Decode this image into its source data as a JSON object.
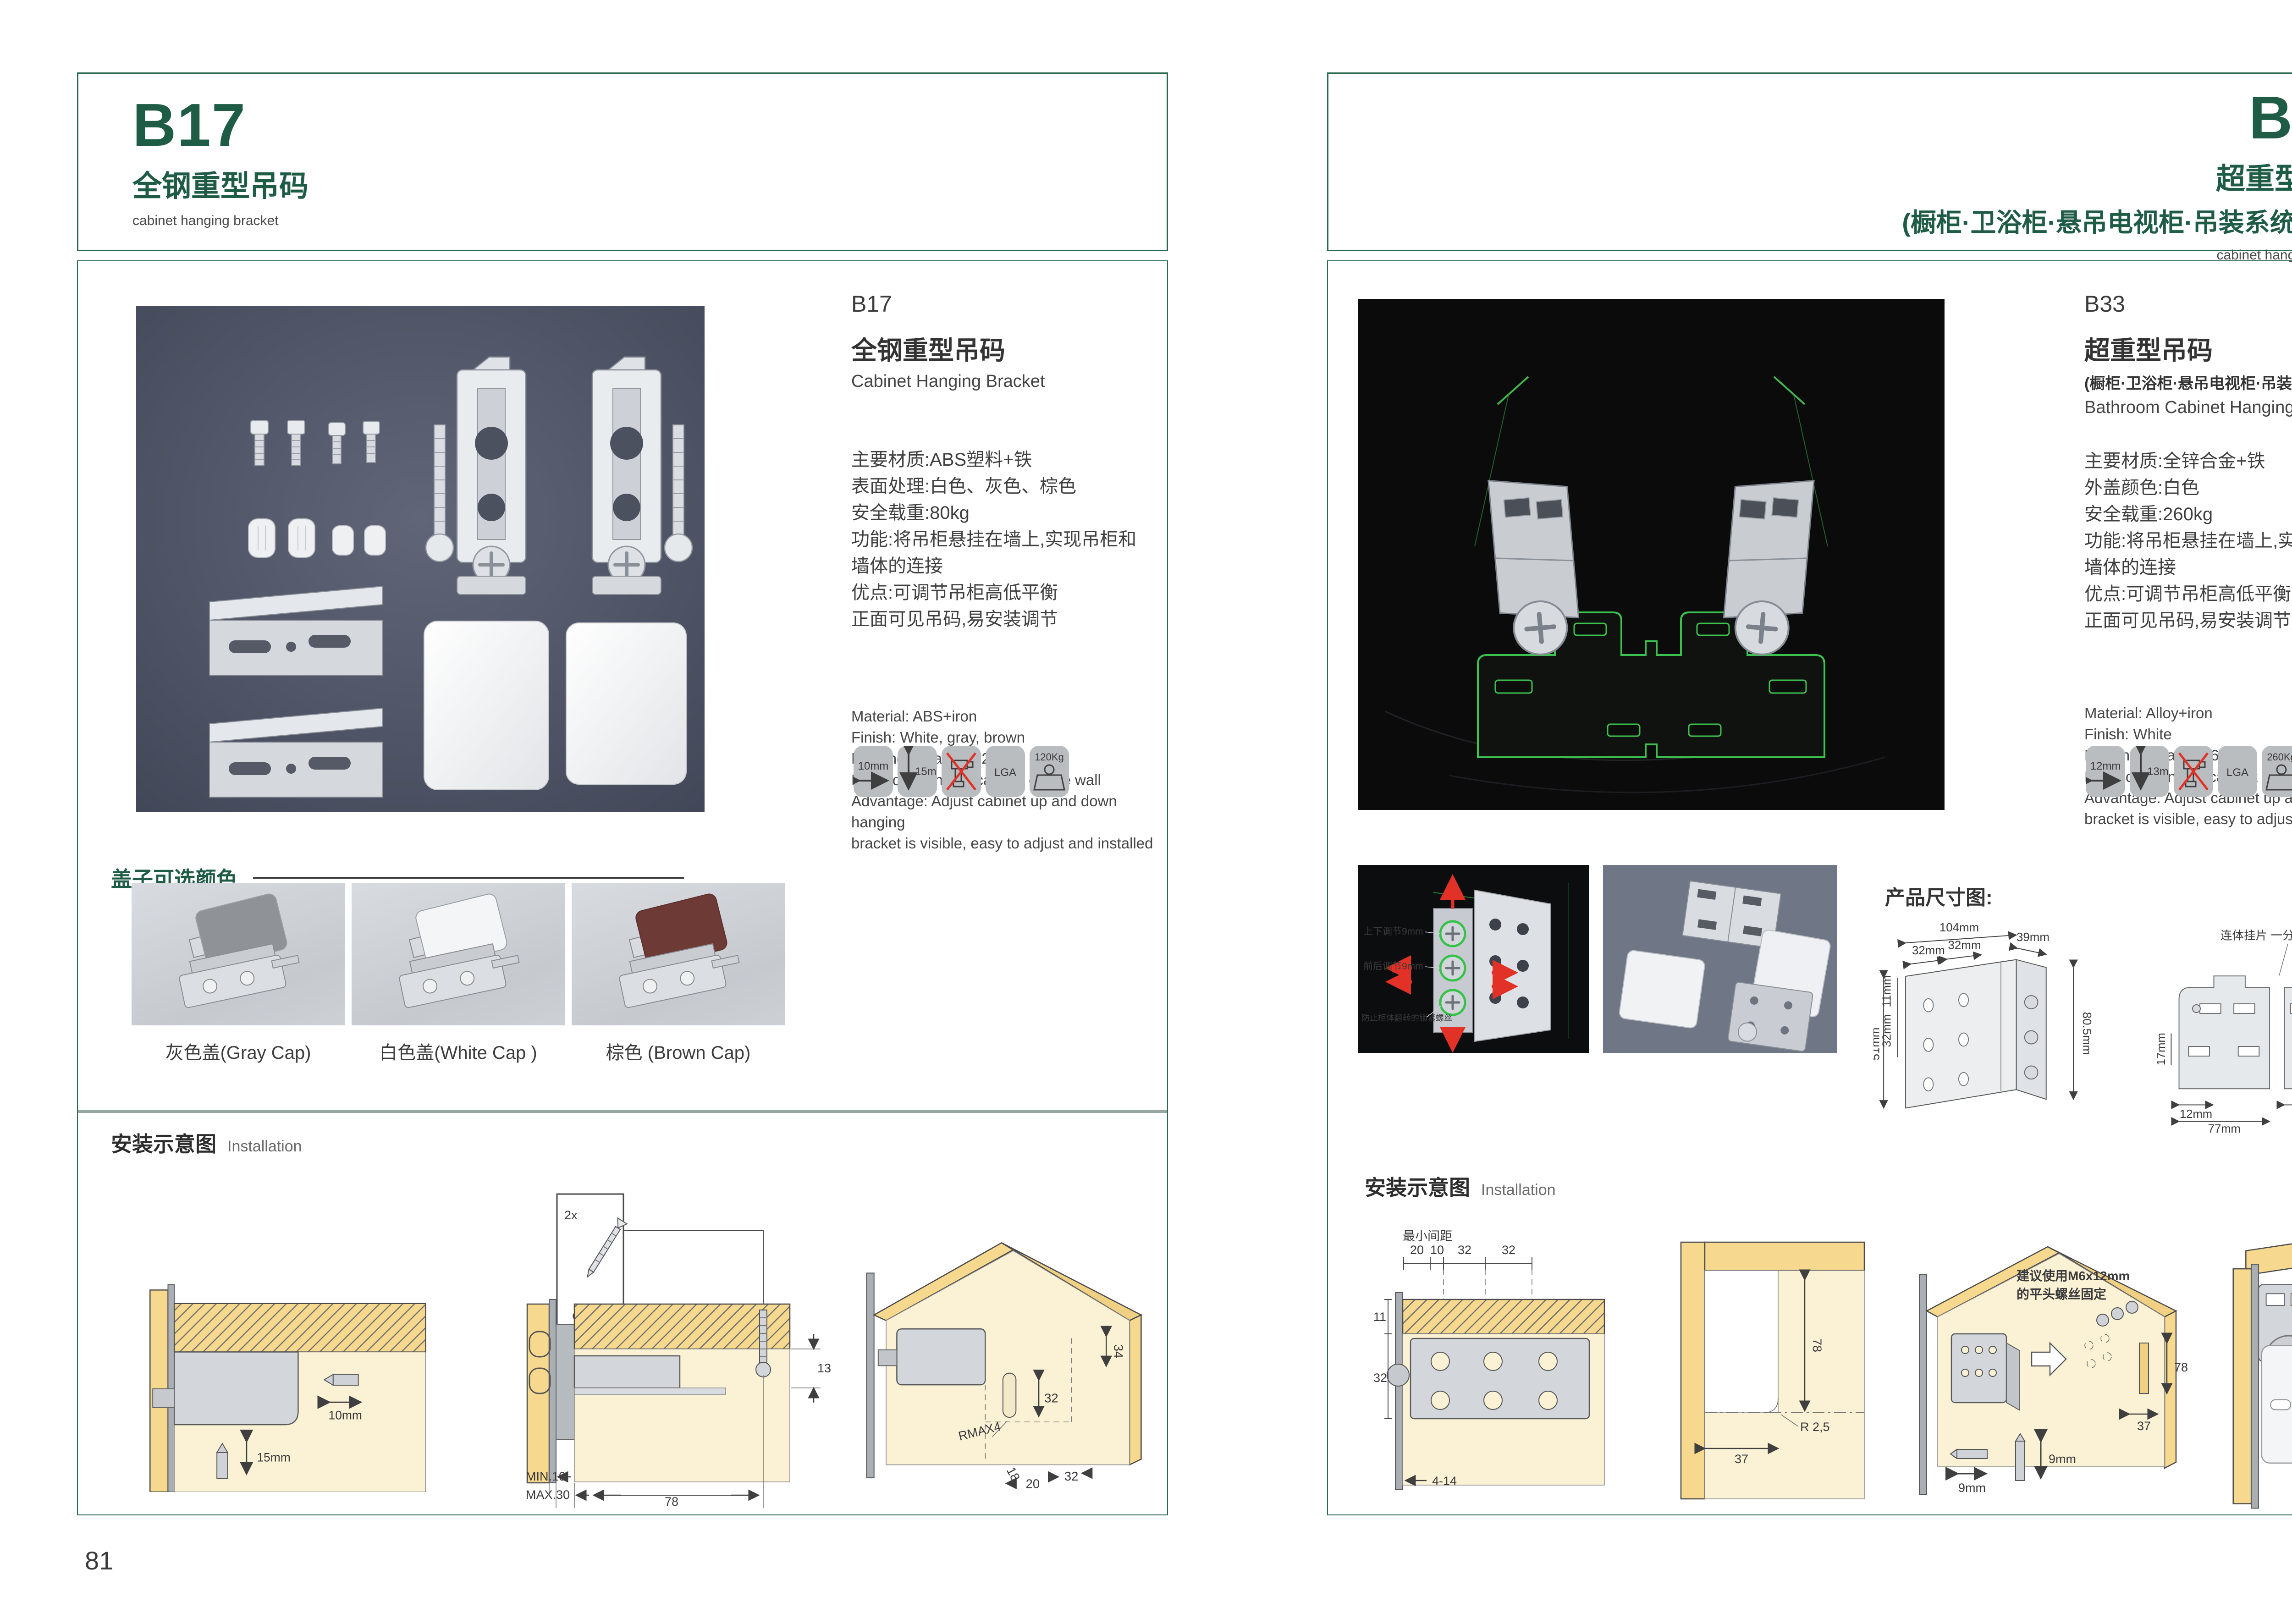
{
  "colors": {
    "brand_green": "#1f5c46",
    "laser_green": "#3cc24e",
    "warn_red": "#e23127",
    "tile_gray": "#b9bdc0"
  },
  "left": {
    "header": {
      "code": "B17",
      "title": "全钢重型吊码",
      "subtitle": "cabinet hanging bracket"
    },
    "info": {
      "code": "B17",
      "title": "全钢重型吊码",
      "title_en": "Cabinet Hanging Bracket",
      "cn": [
        "主要材质:ABS塑料+铁",
        "表面处理:白色、灰色、棕色",
        "安全载重:80kg",
        "功能:将吊柜悬挂在墙上,实现吊柜和",
        "墙体的连接",
        "优点:可调节吊柜高低平衡",
        "正面可见吊码,易安装调节"
      ],
      "en": [
        "Material: ABS+iron",
        "Finish: White, gray, brown",
        "Loading capacity: 120kg",
        "Function: hanging cabinet on the wall",
        "Advantage: Adjust cabinet up and down hanging",
        "bracket is visible, easy to adjust and installed"
      ]
    },
    "icons": {
      "w": "10mm",
      "h": "15mm",
      "lga": "LGA",
      "load": "120Kg"
    },
    "colors_section": {
      "title": "盖子可选颜色",
      "captions": [
        "灰色盖(Gray Cap)",
        "白色盖(White Cap )",
        "棕色 (Brown Cap)"
      ],
      "hex": [
        "#8f9296",
        "#f4f5f6",
        "#6e3a36"
      ]
    },
    "install": {
      "title": "安装示意图",
      "subtitle": "Installation",
      "screw_count": "2x",
      "screw_dia": "φ4mm",
      "d1_w": "10mm",
      "d1_h": "15mm",
      "d2_13": "13",
      "d2_min": "MIN.10",
      "d2_max": "MAX.30",
      "d2_78": "78",
      "d3_34": "34",
      "d3_32a": "32",
      "d3_rmax": "RMAX4",
      "d3_18": "18",
      "d3_20": "20",
      "d3_32b": "32"
    },
    "page_no": "81"
  },
  "right": {
    "header": {
      "code": "B33",
      "title": "超重型吊码",
      "paren": "(橱柜·卫浴柜·悬吊电视柜·吊装系统 专用)",
      "subtitle": "cabinet hanging bracket"
    },
    "info": {
      "code": "B33",
      "title": "超重型吊码",
      "paren": "(橱柜·卫浴柜·悬吊电视柜·吊装系统 专用)",
      "title_en": "Bathroom Cabinet Hanging Bracket",
      "cn": [
        "主要材质:全锌合金+铁",
        "外盖颜色:白色",
        "安全载重:260kg",
        "功能:将吊柜悬挂在墙上,实现吊柜和",
        "墙体的连接",
        "优点:可调节吊柜高低平衡",
        "正面可见吊码,易安装调节"
      ],
      "en": [
        "Material: Alloy+iron",
        "Finish: White",
        "Loading capacity:260kg",
        "Function: hanging cabinet on the wall",
        "Advantage: Adjust cabinet up and down hanging",
        "bracket is visible, easy to adjust and installed"
      ]
    },
    "icons": {
      "w": "12mm",
      "h": "13mm",
      "lga": "LGA",
      "load": "260Kg"
    },
    "photo1": {
      "l1": "上下调节9mm",
      "l2": "前后调节9mm",
      "l3": "防止柜体翻转的锁紧螺丝"
    },
    "dims": {
      "title": "产品尺寸图:",
      "a": {
        "d104": "104mm",
        "d32a": "32mm",
        "d32b": "32mm",
        "d39": "39mm",
        "d11": "11mm",
        "d32c": "32mm",
        "d51": "51mm",
        "d805": "80.5mm"
      },
      "b": {
        "label": "连体挂片 一分为二",
        "d55t": "55mm",
        "d39": "39mm",
        "d55r": "55mm",
        "d8": "8mm",
        "d17": "17mm",
        "d12": "12mm",
        "d63": "63mm",
        "d77": "77mm"
      }
    },
    "install": {
      "title": "安装示意图",
      "subtitle": "Installation",
      "r1_min": "最小间距",
      "r1_20": "20",
      "r1_10": "10",
      "r1_32a": "32",
      "r1_32b": "32",
      "r1_11": "11",
      "r1_32c": "32",
      "r1_414": "4-14",
      "r2_78": "78",
      "r2_r": "R 2,5",
      "r2_37": "37",
      "r3_t1": "建议使用M6x12mm",
      "r3_t2": "的平头螺丝固定",
      "r3_78": "78",
      "r3_37": "37",
      "r3_9a": "9mm",
      "r3_9b": "9mm"
    },
    "page_no": "82"
  }
}
